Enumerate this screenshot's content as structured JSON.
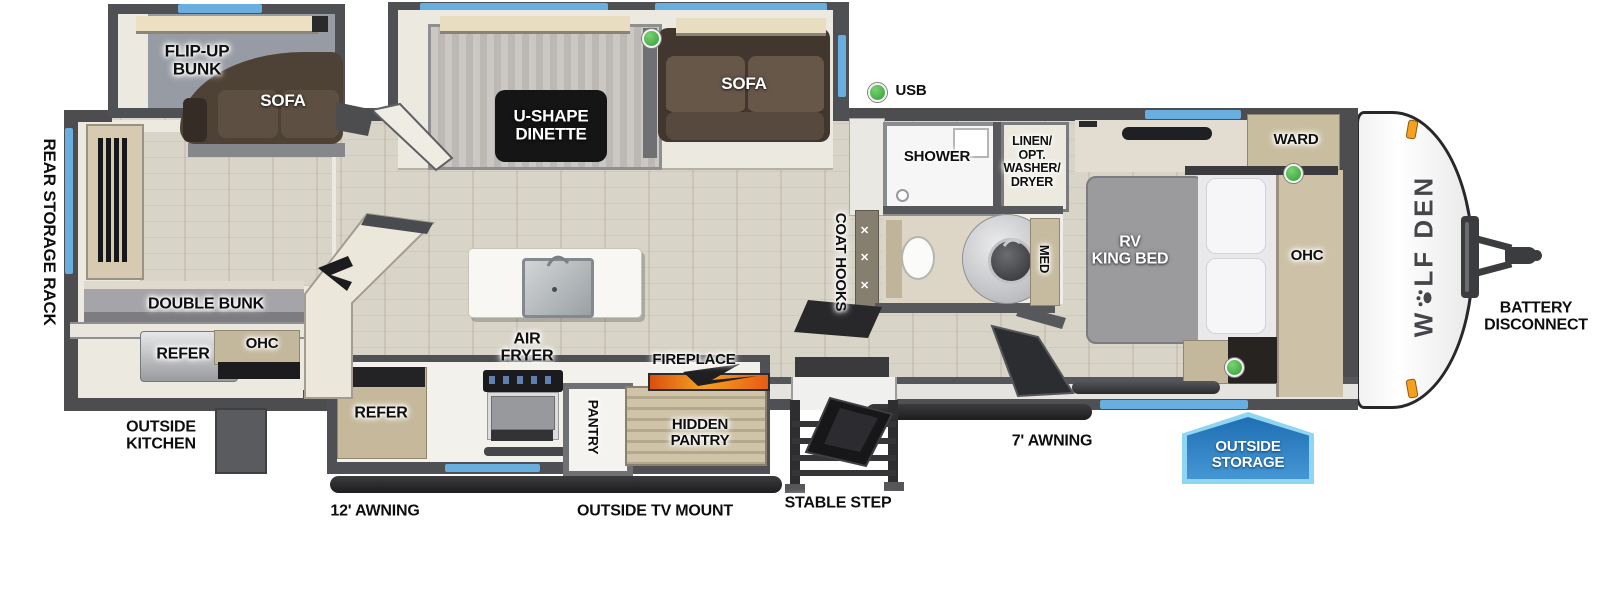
{
  "floorplan": {
    "brand": {
      "name": "WOLF DEN",
      "part1": "W",
      "part2": "LF DEN"
    },
    "labels": {
      "rear_storage_rack": "REAR STORAGE RACK",
      "flip_up_bunk": "FLIP-UP\nBUNK",
      "sofa_bunk": "SOFA",
      "u_shape_dinette": "U-SHAPE\nDINETTE",
      "sofa_living": "SOFA",
      "usb": "USB",
      "shower": "SHOWER",
      "linen": "LINEN/\nOPT.\nWASHER/\nDRYER",
      "ward": "WARD",
      "coat_hooks": "COAT HOOKS",
      "med": "MED",
      "rv_king_bed": "RV\nKING BED",
      "ohc_bedroom": "OHC",
      "double_bunk": "DOUBLE BUNK",
      "refer_rear": "REFER",
      "ohc_rear": "OHC",
      "outside_kitchen": "OUTSIDE\nKITCHEN",
      "refer_kitchen": "REFER",
      "air_fryer": "AIR\nFRYER",
      "pantry": "PANTRY",
      "hidden_pantry": "HIDDEN\nPANTRY",
      "fireplace": "FIREPLACE",
      "awning_12": "12' AWNING",
      "outside_tv_mount": "OUTSIDE TV MOUNT",
      "stable_step": "STABLE STEP",
      "awning_7": "7' AWNING",
      "outside_storage": "OUTSIDE\nSTORAGE",
      "battery_disconnect": "BATTERY\nDISCONNECT"
    },
    "colors": {
      "wall_gray": "#4d4d50",
      "window_blue": "#68aede",
      "indicator_green": "#3fae47",
      "badge_blue": "#2a7cbe",
      "badge_border": "#8fd6f3",
      "clearance_orange": "#f6a01d"
    }
  }
}
